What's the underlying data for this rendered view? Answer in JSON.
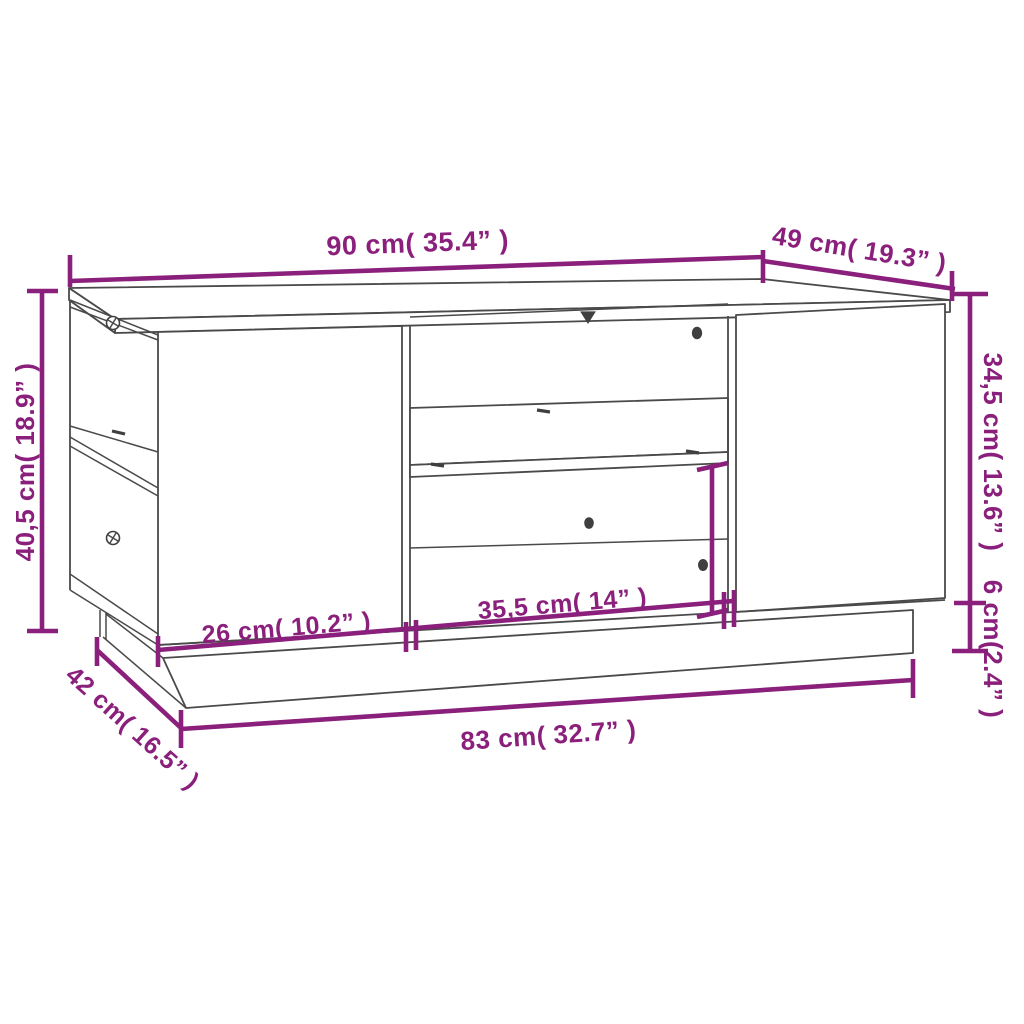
{
  "page": {
    "background": "#ffffff"
  },
  "diagram": {
    "subject": "coffee-table-dimension-drawing",
    "style": {
      "dimension_color": "#8a1f7c",
      "outline_color": "#4a4a4a"
    },
    "dimensions": {
      "top_width": {
        "text": "90 cm( 35.4” )",
        "cm": "90",
        "inch": "35.4"
      },
      "top_depth": {
        "text": "49 cm( 19.3” )",
        "cm": "49",
        "inch": "19.3"
      },
      "total_height": {
        "text": "40,5 cm( 18.9” )",
        "cm": "40,5",
        "inch": "18.9"
      },
      "body_height": {
        "text": "34,5 cm( 13.6” )",
        "cm": "34,5",
        "inch": "13.6"
      },
      "base_height": {
        "text": "6 cm(2.4” )",
        "cm": "6",
        "inch": "2.4"
      },
      "left_door_width": {
        "text": "26 cm( 10.2” )",
        "cm": "26",
        "inch": "10.2"
      },
      "opening_width": {
        "text": "35,5 cm( 14” )",
        "cm": "35,5",
        "inch": "14"
      },
      "base_depth": {
        "text": "42 cm( 16.5” )",
        "cm": "42",
        "inch": "16.5"
      },
      "base_width": {
        "text": "83 cm( 32.7” )",
        "cm": "83",
        "inch": "32.7"
      }
    }
  }
}
